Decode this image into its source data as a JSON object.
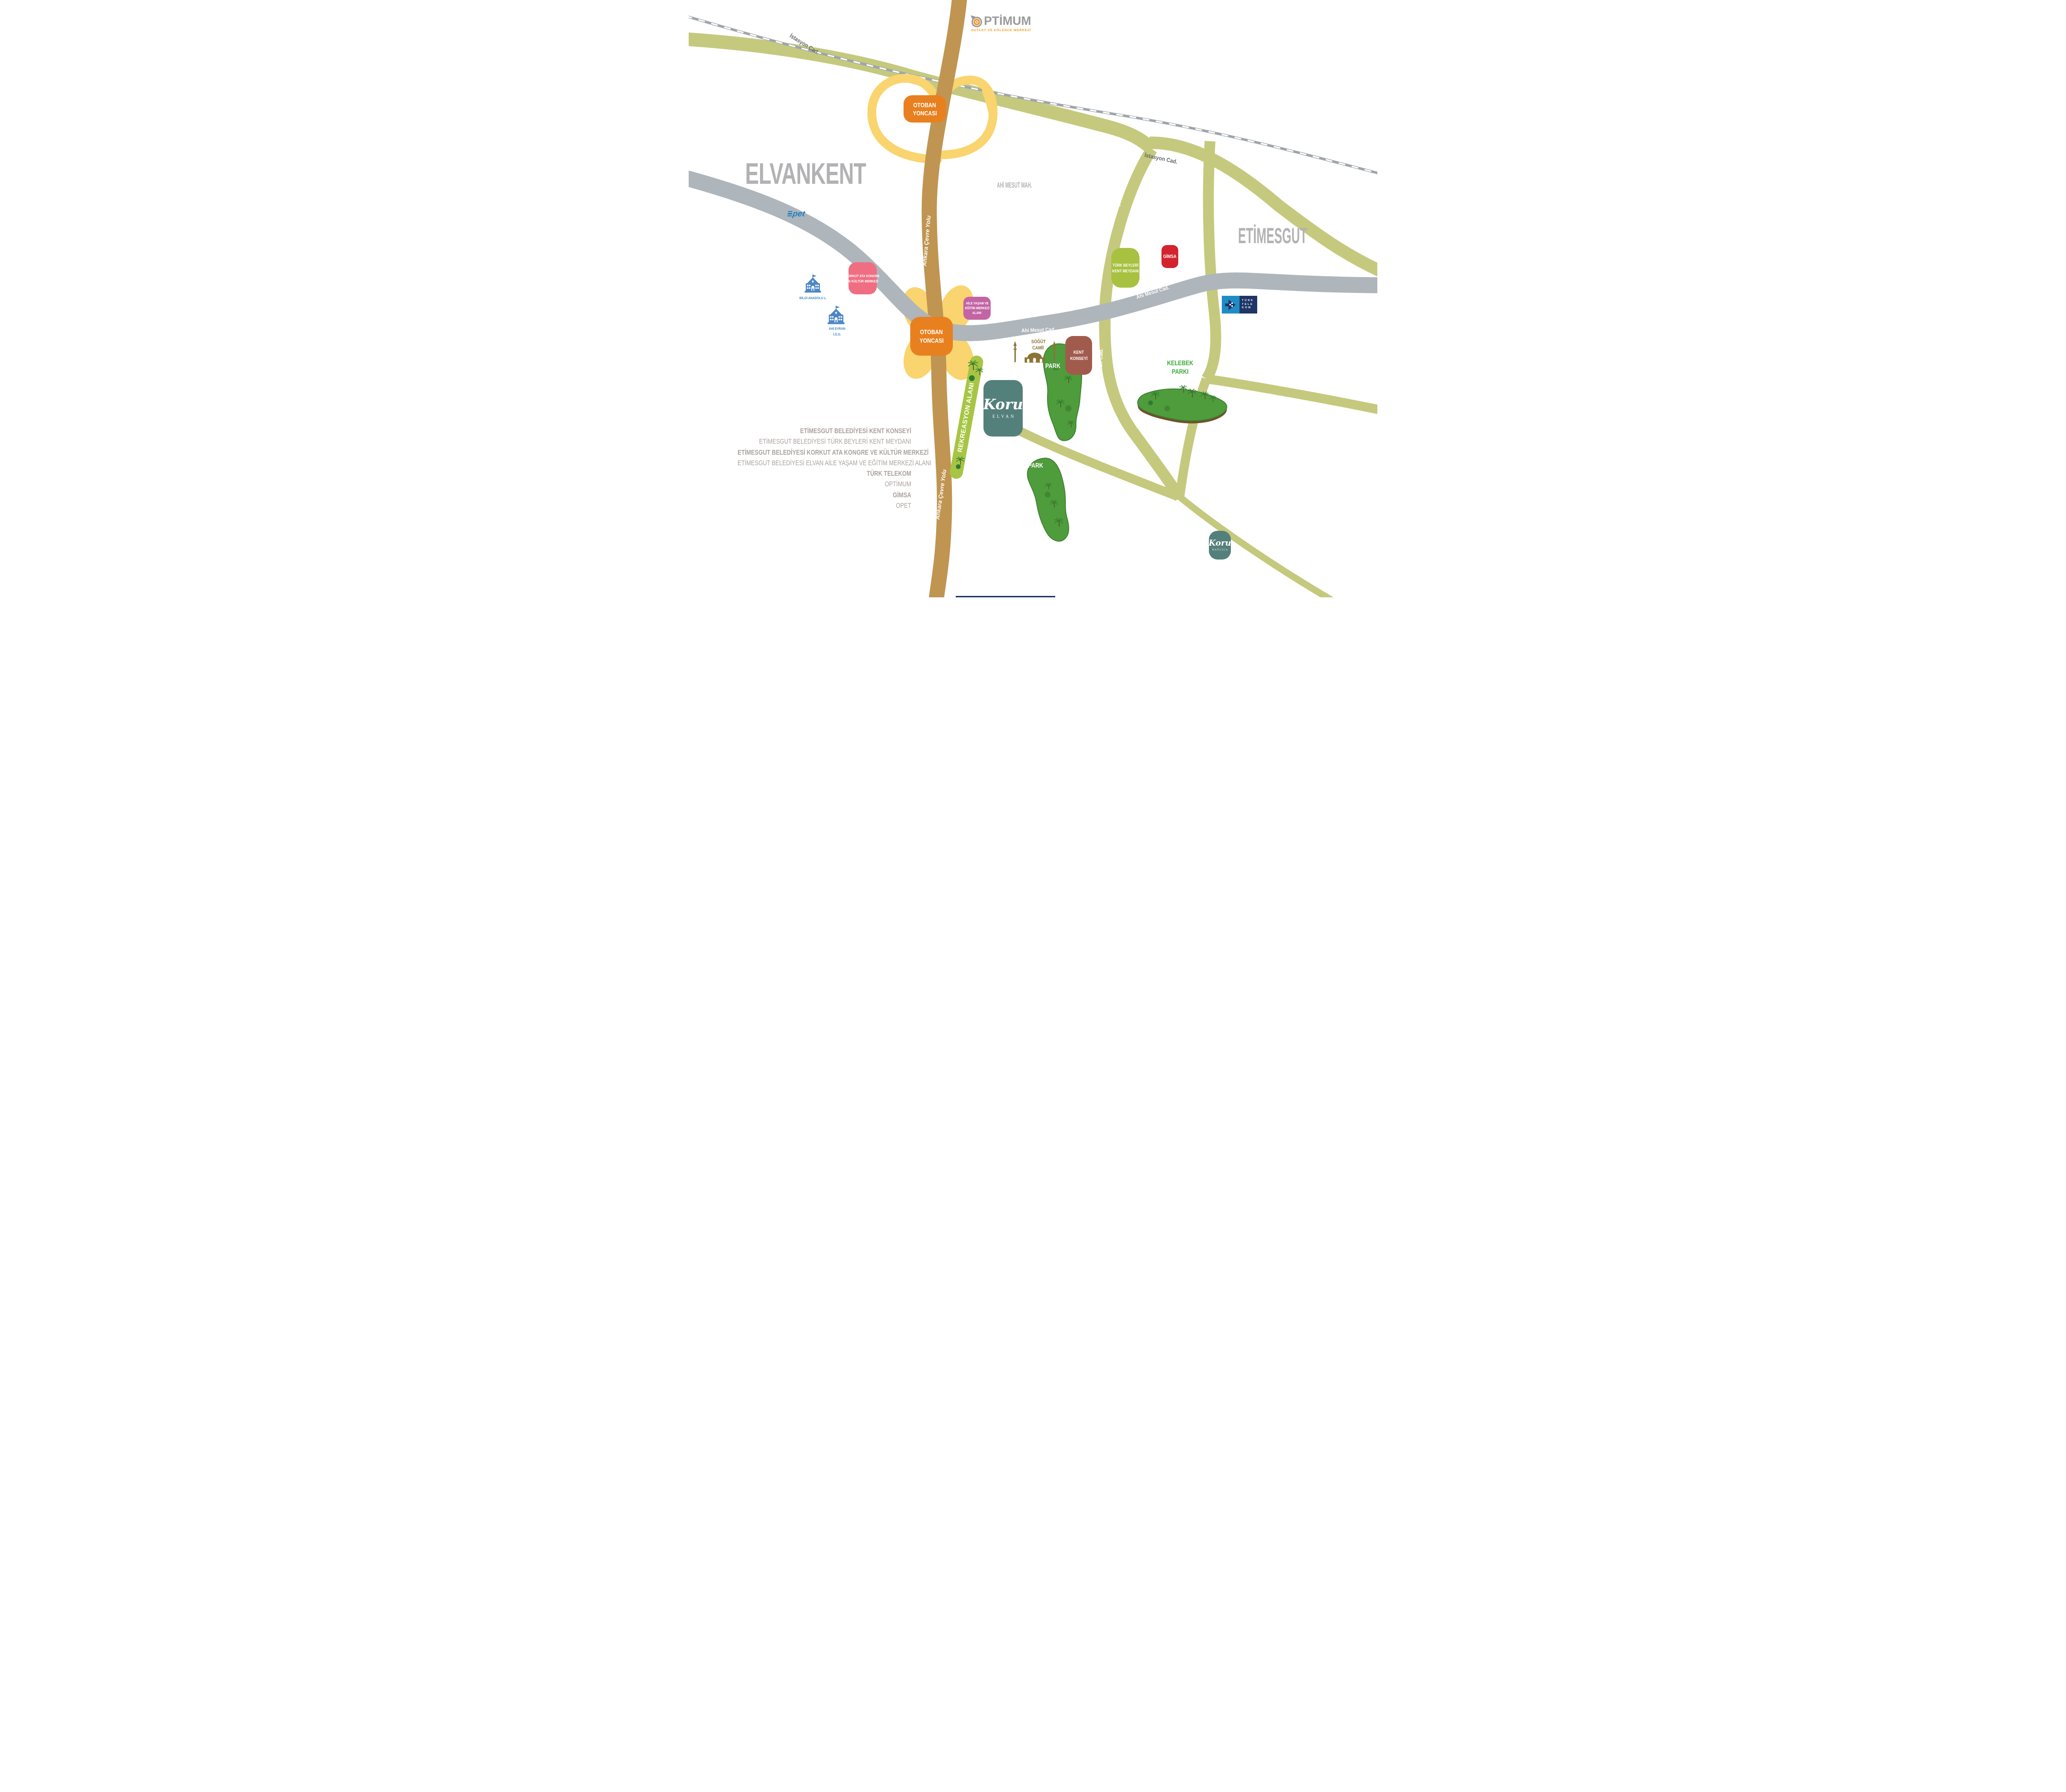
{
  "map": {
    "regions": {
      "elvankent": "ELVANKENT",
      "ahi_mesut_mah": "AHİ MESUT MAH.",
      "etimesgut": "ETİMESGUT"
    },
    "roads": {
      "istasyon": "İstasyon Cad.",
      "ahi_mesut": "Ahi Mesut Cad.",
      "ankara_cevre": "Ankara Çevre Yolu",
      "ahi_evran": "Ahi Evran Cad.",
      "zirve": "Zirve Cad."
    },
    "badges": {
      "otoban_yoncasi": {
        "line1": "OTOBAN",
        "line2": "YONCASI",
        "color": "#E8801F"
      },
      "korkut": {
        "line1": "KORKUT ATA KONGRE",
        "line2": "VE KÜLTÜR MERKEZİ",
        "color": "#F06E82"
      },
      "aile": {
        "line1": "AİLE YAŞAM VE",
        "line2": "EĞİTİM MERKEZİ",
        "line3": "ALANI",
        "color": "#C364A4"
      },
      "turk_beyleri": {
        "line1": "TÜRK BEYLERİ",
        "line2": "KENT MEYDANI",
        "color": "#A8C140"
      },
      "gimsa": {
        "label": "GİMSA",
        "color": "#D2232E"
      },
      "kent_konseyi": {
        "line1": "KENT",
        "line2": "KONSEYİ",
        "color": "#A15B4D"
      }
    },
    "logos": {
      "optimum": {
        "title": "PTİMUM",
        "tagline": "OUTLET VE EĞLENCE MERKEZİ"
      },
      "opet": {
        "label": "pet"
      },
      "turk_telekom": {
        "line1": "TÜRK",
        "line2": "TELE",
        "line3": "KOM"
      },
      "koru_elvan": {
        "script": "Koru",
        "sub": "ELVAN"
      },
      "koru_baglica": {
        "script": "Koru",
        "sub": "BAĞLICA"
      }
    },
    "pois": {
      "bilgi_anadolu": "BİLGİ ANADOLU L.",
      "ahi_evran_school_1": "AHİ EVRAN",
      "ahi_evran_school_2": "İ.Ö.O.",
      "mosque_1": "SÖĞÜT",
      "mosque_2": "CAMİİ",
      "park": "PARK",
      "kelebek_1": "KELEBEK",
      "kelebek_2": "PARKI",
      "rekreasyon": "REKREASYON ALANI"
    },
    "legend": {
      "items": [
        {
          "text": "ETİMESGUT BELEDİYESİ KENT KONSEYİ",
          "bold": true
        },
        {
          "text": "ETİMESGUT BELEDİYESİ TÜRK BEYLERİ KENT MEYDANI",
          "bold": false
        },
        {
          "text": "ETİMESGUT BELEDİYESİ KORKUT ATA KONGRE VE KÜLTÜR MERKEZİ",
          "bold": true
        },
        {
          "text": "ETİMESGUT BELEDİYESİ ELVAN AİLE YAŞAM VE EĞİTİM MERKEZİ ALANI",
          "bold": false
        },
        {
          "text": "TÜRK TELEKOM",
          "bold": true
        },
        {
          "text": "OPTİMUM",
          "bold": false
        },
        {
          "text": "GİMSA",
          "bold": true
        },
        {
          "text": "OPET",
          "bold": false
        }
      ]
    },
    "colors": {
      "highway_brown": "#BF9551",
      "ramp_yellow": "#F9D46F",
      "street_olive": "#C5C97D",
      "street_gray": "#AEB5BB",
      "railway_gray": "#9EA5AA",
      "park_green": "#4E9C3C",
      "rekreasyon_green": "#A7C544",
      "region_gray": "#B2B2B4",
      "school_blue": "#4486C6",
      "mosque_olive": "#8B7434",
      "teal": "#54807B"
    }
  }
}
